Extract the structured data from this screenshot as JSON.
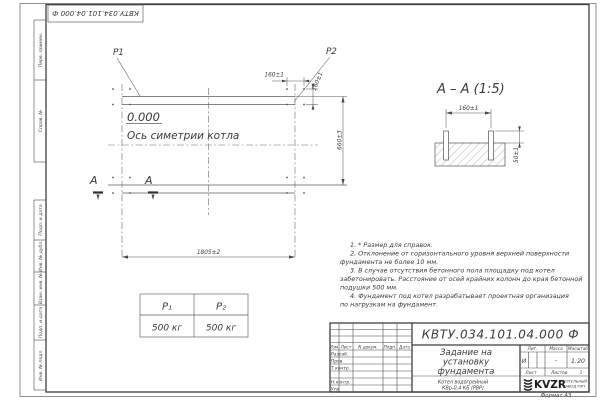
{
  "doc_number": "КВТУ.034.101.04.000  Ф",
  "left_margin": {
    "cells": [
      "Перв. примен.",
      "Справ. №",
      "Подп. и дата",
      "Инв. № дубл.",
      "Взам. инв. №",
      "Подп. и дата",
      "Инв. № подл."
    ]
  },
  "plan": {
    "p1_label": "P1",
    "p2_label": "P2",
    "level_mark": "0.000",
    "axis_label": "Ось симетрии котла",
    "dim_160_top": "160±1",
    "dim_160_side": "160±1",
    "dim_660": "660±3",
    "dim_1805": "1805±2",
    "section_letter_1": "А",
    "section_letter_2": "А"
  },
  "section_view": {
    "title": "А – А (1:5)",
    "dim_160": "160±1",
    "dim_50": "50±1"
  },
  "load_table": {
    "headers": [
      "P₁",
      "P₂"
    ],
    "values": [
      "500 кг",
      "500 кг"
    ]
  },
  "notes": {
    "lines": [
      "1. * Размер для справок.",
      "2. Отклонение от горизонтального уровня верхней поверхности",
      "фундамента не более 10 мм.",
      "3. В случае отсутствия бетонного пола площадку под котел",
      "забетонировать. Расстояние от осей крайних колонн до края бетонной",
      "подушки 500 мм.",
      "4. Фундамент под котел разрабатывает проектная организация",
      "по нагрузкам на фундамент."
    ]
  },
  "title_block": {
    "header_cols": [
      "Изм.",
      "Лист",
      "N докум.",
      "Подп.",
      "Дата"
    ],
    "rows": [
      "Разраб.",
      "Пров.",
      "Т.контр.",
      "Н.контр.",
      "Утв."
    ],
    "doc_number": "КВТУ.034.101.04.000  Ф",
    "title_lines": [
      "Задание на",
      "установку",
      "фундамента"
    ],
    "lit_label": "Лит.",
    "lit_value": "И",
    "mass_label": "Масса",
    "mass_value": "-",
    "scale_label": "Масштаб",
    "scale_value": "1:20",
    "sheet_label": "Лист",
    "sheets_label": "Листов",
    "sheets_value": "1",
    "product_lines": [
      "Котел водогрейный",
      "КВр-0,4  КБ  (РВР)"
    ],
    "company_logo": "KVZR",
    "company_lines": [
      "КОТЕЛЬНЫЙ",
      "ЗАВОД РЭП"
    ],
    "format_label": "Формат А3"
  }
}
